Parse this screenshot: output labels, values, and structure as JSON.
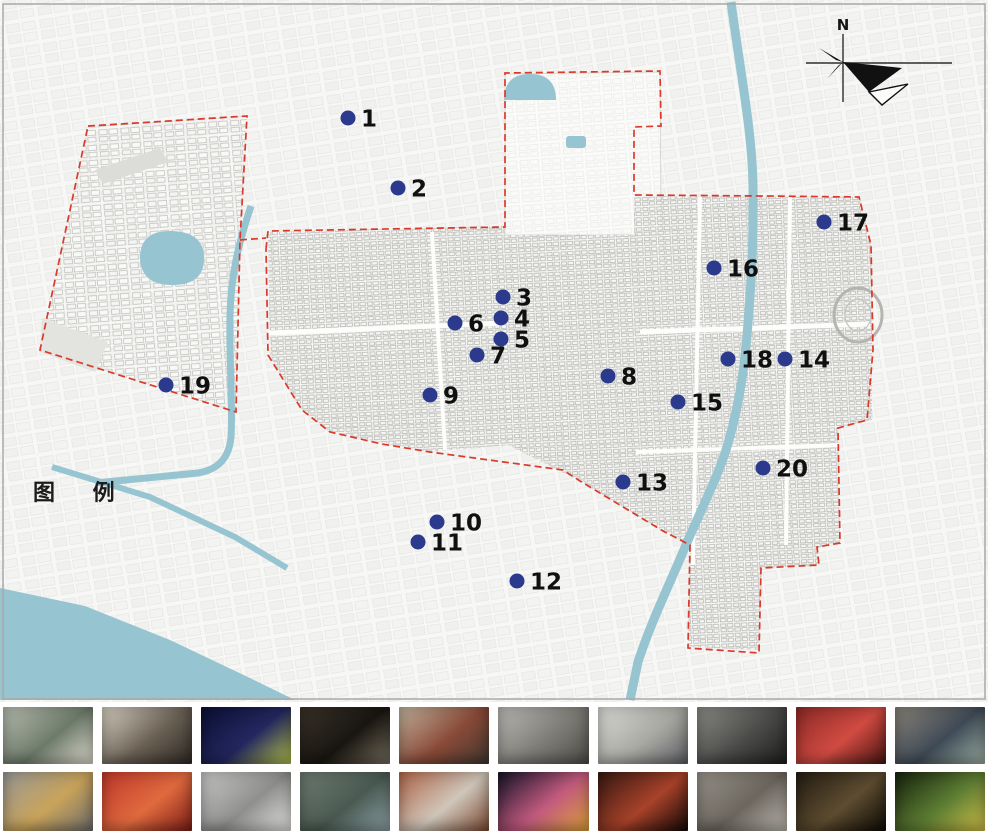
{
  "map": {
    "legend_label": "图 例",
    "compass_label": "N",
    "colors": {
      "dot": "#2b3a8c",
      "number_label": "#101010",
      "boundary": "#d93a2b",
      "water": "#96c5d1",
      "fabric_line": "#b4b4b0",
      "frame": "#a8a8a5"
    },
    "points": [
      {
        "n": "1",
        "x": 348,
        "y": 118
      },
      {
        "n": "2",
        "x": 398,
        "y": 188
      },
      {
        "n": "3",
        "x": 503,
        "y": 297
      },
      {
        "n": "4",
        "x": 501,
        "y": 318
      },
      {
        "n": "5",
        "x": 501,
        "y": 339
      },
      {
        "n": "6",
        "x": 455,
        "y": 323
      },
      {
        "n": "7",
        "x": 477,
        "y": 355
      },
      {
        "n": "8",
        "x": 608,
        "y": 376
      },
      {
        "n": "9",
        "x": 430,
        "y": 395
      },
      {
        "n": "10",
        "x": 437,
        "y": 522
      },
      {
        "n": "11",
        "x": 418,
        "y": 542
      },
      {
        "n": "12",
        "x": 517,
        "y": 581
      },
      {
        "n": "13",
        "x": 623,
        "y": 482
      },
      {
        "n": "14",
        "x": 785,
        "y": 359
      },
      {
        "n": "15",
        "x": 678,
        "y": 402
      },
      {
        "n": "16",
        "x": 714,
        "y": 268
      },
      {
        "n": "17",
        "x": 824,
        "y": 222
      },
      {
        "n": "18",
        "x": 728,
        "y": 359
      },
      {
        "n": "19",
        "x": 166,
        "y": 385
      },
      {
        "n": "20",
        "x": 763,
        "y": 468
      }
    ]
  },
  "gallery": {
    "rows": [
      {
        "items": [
          {
            "id": "r1p1",
            "subject": "traditional shophouse street scene",
            "colors": [
              "#b9c0b2",
              "#6d7a6a",
              "#e4e0d4"
            ]
          },
          {
            "id": "r1p2",
            "subject": "old storefront with inscribed signboard",
            "colors": [
              "#d8d2c4",
              "#6a6054",
              "#2f2a24"
            ]
          },
          {
            "id": "r1p3",
            "subject": "night lantern show with glowing dragon figures",
            "colors": [
              "#0b1034",
              "#23275f",
              "#b7c44a"
            ]
          },
          {
            "id": "r1p4",
            "subject": "dark museum workshop interior",
            "colors": [
              "#3a332a",
              "#191611",
              "#77705f"
            ]
          },
          {
            "id": "r1p5",
            "subject": "teahouse interior with red lantern",
            "colors": [
              "#c3b49e",
              "#8a4a38",
              "#403830"
            ]
          },
          {
            "id": "r1p6",
            "subject": "gray colonnade courtyard of historic building",
            "colors": [
              "#bdbcb8",
              "#7d7c76",
              "#4e4c47"
            ]
          },
          {
            "id": "r1p7",
            "subject": "white historic arcade facade",
            "colors": [
              "#dcdcd8",
              "#a9a9a3",
              "#5f6066"
            ]
          },
          {
            "id": "r1p8",
            "subject": "black-and-white portrait of craftsman at work",
            "colors": [
              "#8d8d89",
              "#4a4a48",
              "#1e1e1d"
            ]
          },
          {
            "id": "r1p9",
            "subject": "red shrine altar with lanterns",
            "colors": [
              "#8f2a26",
              "#d04b42",
              "#4a1512"
            ]
          },
          {
            "id": "r1p10",
            "subject": "exhibition hall with jars and blue-lit ceiling",
            "colors": [
              "#8b857b",
              "#3f4a56",
              "#9fb3a6"
            ]
          }
        ]
      },
      {
        "items": [
          {
            "id": "r2p1",
            "subject": "gold openwork bracelet artifact on gray",
            "colors": [
              "#9a9a98",
              "#c9a35a",
              "#6f6f6d"
            ]
          },
          {
            "id": "r2p2",
            "subject": "red dyed fabric strips hanging",
            "colors": [
              "#c23a2c",
              "#e06a3e",
              "#7e1f18"
            ]
          },
          {
            "id": "r2p3",
            "subject": "black-and-white exhibition hall interior",
            "colors": [
              "#c9c9c7",
              "#8f8f8d",
              "#e8e8e6"
            ]
          },
          {
            "id": "r2p4",
            "subject": "courtyard pool of traditional residence",
            "colors": [
              "#6f7d72",
              "#4a5a52",
              "#8fa3a8"
            ]
          },
          {
            "id": "r2p5",
            "subject": "red-brick temple with swallowtail roof",
            "colors": [
              "#b2674a",
              "#cfc6ba",
              "#7e4a33"
            ]
          },
          {
            "id": "r2p6",
            "subject": "colorful glowing puppets at night",
            "colors": [
              "#141428",
              "#c25a7e",
              "#e0a53a"
            ]
          },
          {
            "id": "r2p7",
            "subject": "old street at night with red lights",
            "colors": [
              "#371812",
              "#a8422a",
              "#120806"
            ]
          },
          {
            "id": "r2p8",
            "subject": "vintage machinery exhibit",
            "colors": [
              "#98938b",
              "#6b665e",
              "#c0bbb3"
            ]
          },
          {
            "id": "r2p9",
            "subject": "arched gateway exhibit in dark hall",
            "colors": [
              "#241d12",
              "#5d4c30",
              "#0e0b06"
            ]
          },
          {
            "id": "r2p10",
            "subject": "night park trees with festive lights",
            "colors": [
              "#16230e",
              "#5d7d33",
              "#d3c24a"
            ]
          }
        ]
      }
    ]
  }
}
